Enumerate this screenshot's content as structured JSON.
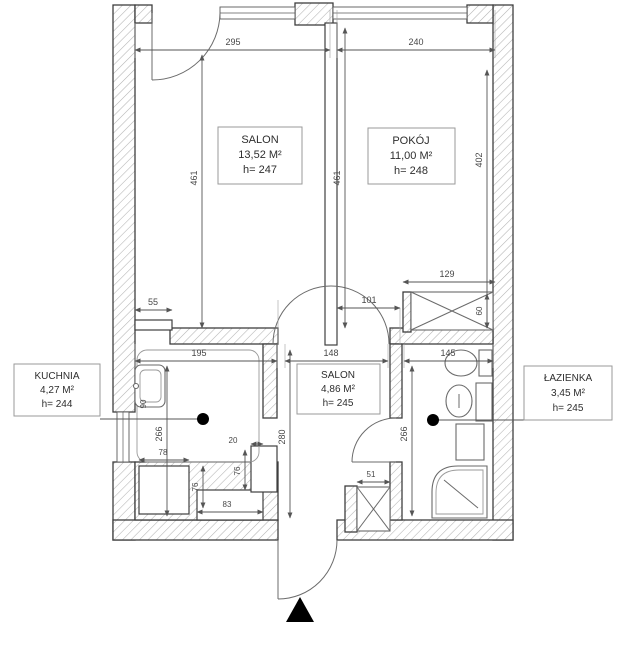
{
  "plan": {
    "rooms": {
      "salon": {
        "name": "SALON",
        "area": "13,52 M²",
        "height": "h= 247"
      },
      "pokoj": {
        "name": "POKÓJ",
        "area": "11,00 M²",
        "height": "h= 248"
      },
      "kuchnia": {
        "name": "KUCHNIA",
        "area": "4,27 M²",
        "height": "h= 244"
      },
      "hall": {
        "name": "SALON",
        "area": "4,86 M²",
        "height": "h= 245"
      },
      "lazienka": {
        "name": "ŁAZIENKA",
        "area": "3,45 M²",
        "height": "h= 245"
      }
    },
    "dims": {
      "w_salon": "295",
      "w_pokoj": "240",
      "h_salon": "461",
      "h_divider": "461",
      "h_pokoj": "402",
      "wall_stub": "55",
      "w_kuchnia": "195",
      "w_hall": "148",
      "w_lazienka": "145",
      "opening_pokoj": "101",
      "wardrobe_w": "129",
      "wardrobe_d": "60",
      "d_kuchnia": "266",
      "d_hall": "280",
      "d_lazienka": "266",
      "niche_w": "78",
      "niche_d": "76",
      "niche_inner": "83",
      "chimney_d": "76",
      "chimney_w": "20",
      "shaft_w": "51",
      "sink_w": "90"
    },
    "colors": {
      "wall_line": "#3f3f3f",
      "hatch": "#b3b3b3",
      "dim": "#474747",
      "label_border": "#9a9a9a",
      "marker": "#000000"
    }
  }
}
